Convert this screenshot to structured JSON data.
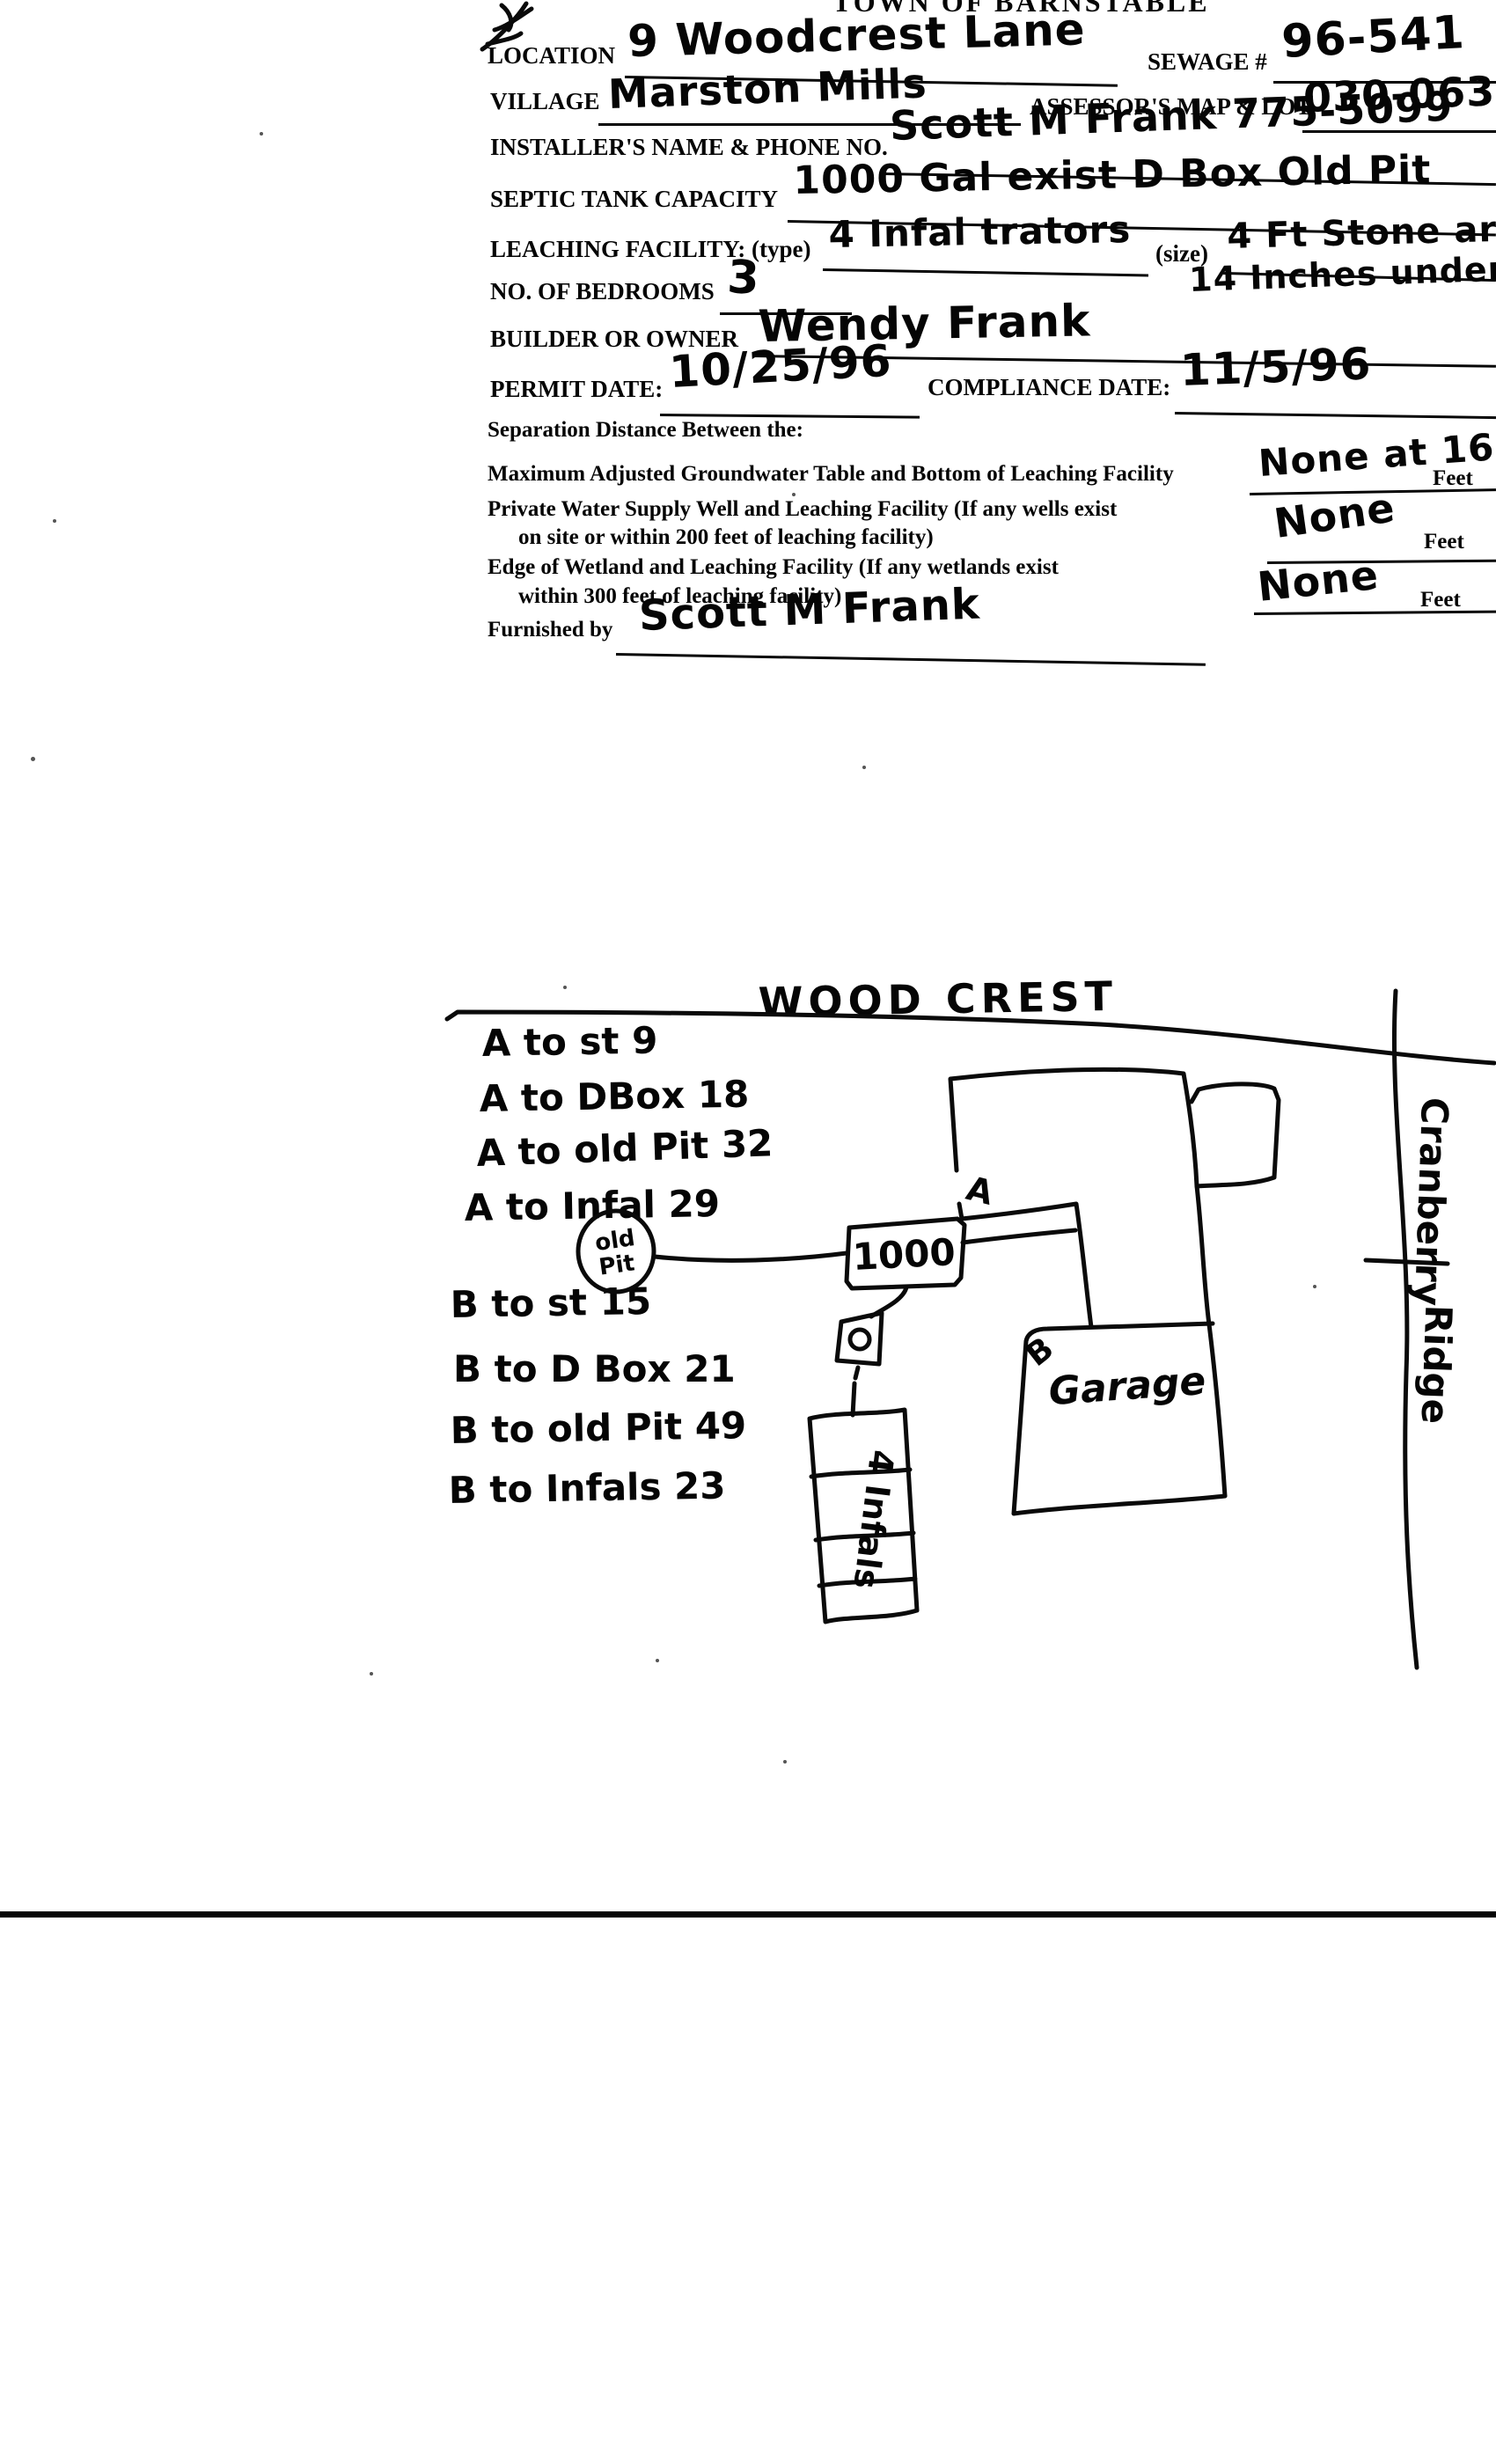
{
  "form": {
    "title": "TOWN OF BARNSTABLE",
    "location_label": "LOCATION",
    "location_value": "9 Woodcrest Lane",
    "sewage_label": "SEWAGE #",
    "sewage_value": "96-541",
    "village_label": "VILLAGE",
    "village_value": "Marston Mills",
    "assessors_label": "ASSESSOR'S MAP & LOT",
    "assessors_value": "030-063",
    "installer_label": "INSTALLER'S NAME & PHONE NO.",
    "installer_value": "Scott M Frank 775-5099",
    "septic_label": "SEPTIC TANK CAPACITY",
    "septic_value": "1000 Gal exist D Box Old Pit",
    "leaching_label": "LEACHING FACILITY: (type)",
    "leaching_type_value": "4 Infal trators",
    "size_label": "(size)",
    "size_value": "4 Ft Stone around",
    "size_note": "14 Inches under",
    "bedrooms_label": "NO. OF BEDROOMS",
    "bedrooms_value": "3",
    "builder_label": "BUILDER OR OWNER",
    "builder_value": "Wendy Frank",
    "permit_label": "PERMIT DATE:",
    "permit_value": "10/25/96",
    "compliance_label": "COMPLIANCE DATE:",
    "compliance_value": "11/5/96",
    "separation_heading": "Separation Distance Between the:",
    "separation": [
      {
        "line1": "Maximum Adjusted Groundwater Table and Bottom of Leaching Facility",
        "line2": "",
        "value": "None at 16",
        "unit": "Feet"
      },
      {
        "line1": "Private Water Supply Well and Leaching Facility  (If any wells exist",
        "line2": "on site or within 200 feet of leaching facility)",
        "value": "None",
        "unit": "Feet"
      },
      {
        "line1": "Edge of Wetland and Leaching Facility (If any wetlands exist",
        "line2": "within 300 feet of leaching facility)",
        "value": "None",
        "unit": "Feet"
      }
    ],
    "furnished_label": "Furnished by",
    "furnished_value": "Scott M Frank"
  },
  "sketch": {
    "street_top": "WOOD CREST",
    "street_right_line1": "Cranberry",
    "street_right_line2": "Ridge",
    "distances_a": [
      "A to st 9",
      "A to DBox 18",
      "A to old Pit 32",
      "A to Infal 29"
    ],
    "distances_b": [
      "B to st 15",
      "B to D Box 21",
      "B to old Pit 49",
      "B to Infals 23"
    ],
    "old_pit_line1": "old",
    "old_pit_line2": "Pit",
    "tank_label": "1000",
    "infiltrator_label": "4 Infals",
    "garage_label": "Garage",
    "point_a": "A",
    "point_b": "B"
  }
}
